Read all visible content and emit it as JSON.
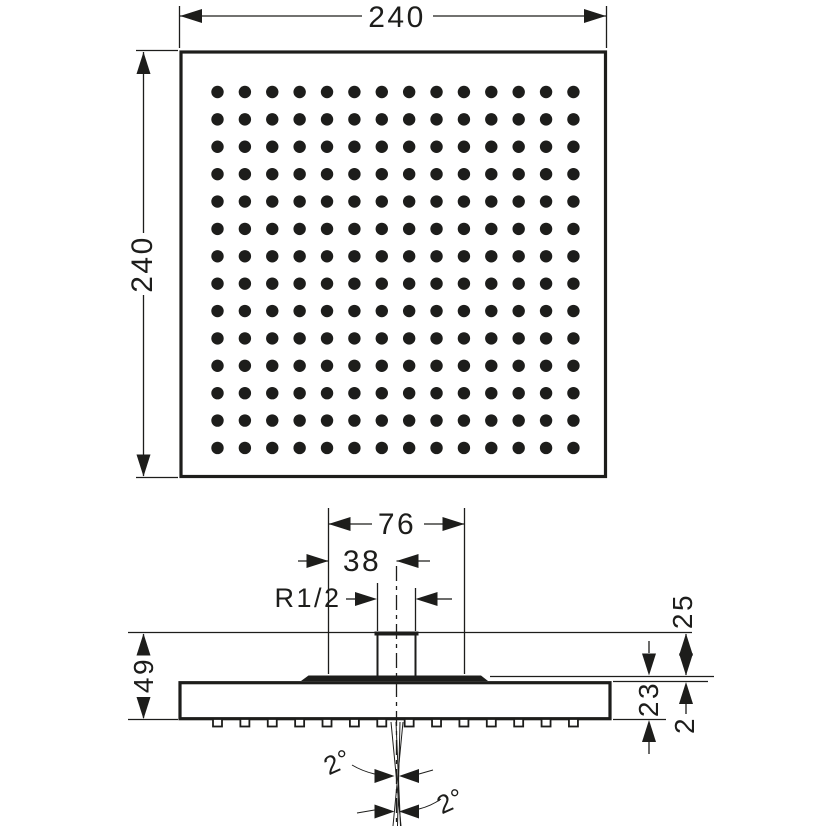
{
  "colors": {
    "ink": "#1d1d1b",
    "background": "#ffffff"
  },
  "top_view": {
    "width_dim": "240",
    "height_dim": "240",
    "dot_grid": {
      "rows": 14,
      "cols": 14,
      "start_x": 217.5,
      "start_y": 92,
      "spacing": 27.38,
      "radius": 6.2
    }
  },
  "side_view": {
    "dims": {
      "spray_plate_width": "76",
      "offset_to_center": "38",
      "thread_size": "R1/2",
      "total_height": "49",
      "connector_height": "25",
      "body_height": "23",
      "plate_reveal": "2",
      "spray_angle_front": "2°",
      "spray_angle_side": "2°"
    },
    "nozzle_row": {
      "count": 14,
      "start_x": 217.5,
      "spacing": 27.38,
      "y": 719,
      "width": 9,
      "height": 7.5
    }
  }
}
